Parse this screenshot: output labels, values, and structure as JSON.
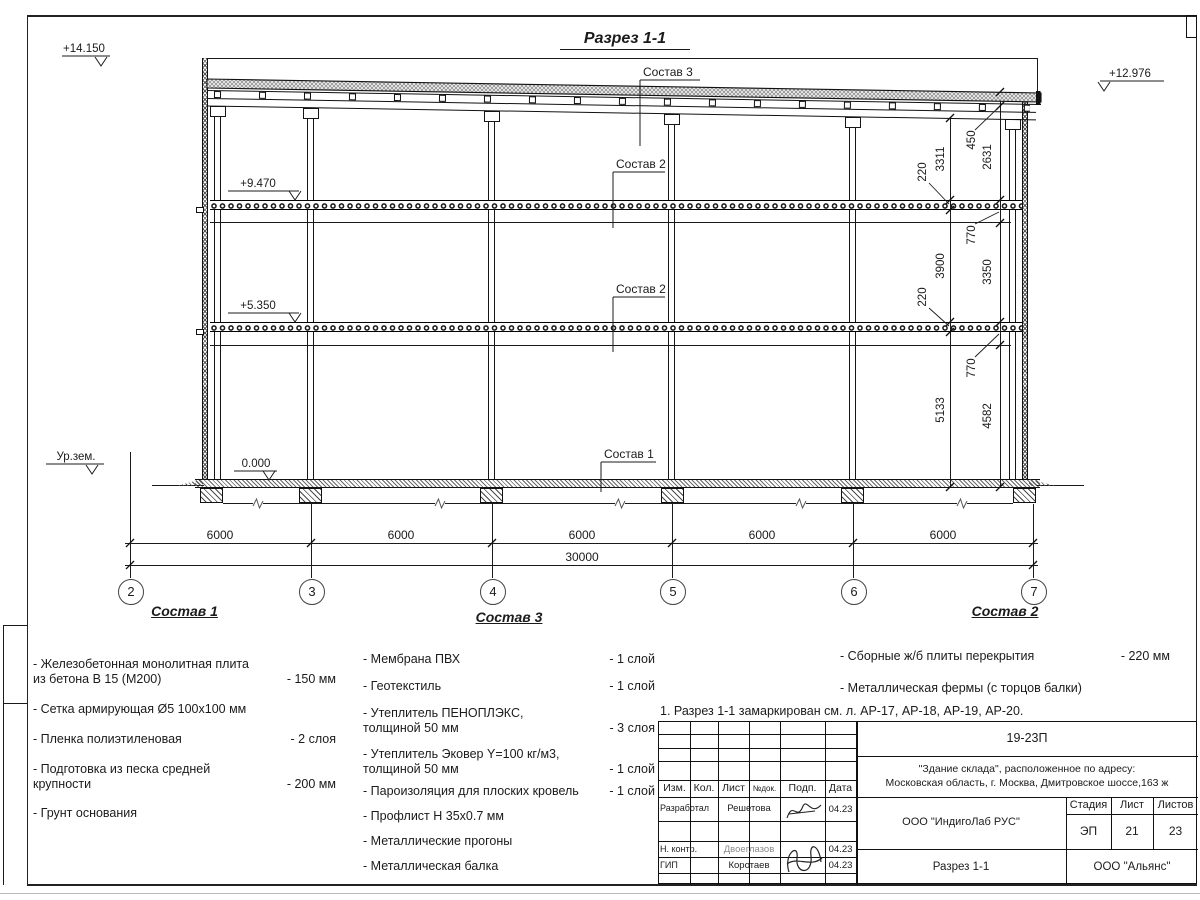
{
  "colors": {
    "line": "#1b1b1b",
    "hatch": "#8f8f8f"
  },
  "drawing": {
    "title": "Разрез 1-1",
    "elevation_marks": {
      "parapet": "+14.150",
      "roof_right": "+12.976",
      "slab_upper": "+9.470",
      "slab_lower": "+5.350",
      "floor": "0.000",
      "ground": "Ур.зем."
    },
    "composition_leaders": {
      "roof": "Состав 3",
      "slab_upper": "Состав 2",
      "slab_lower": "Состав 2",
      "floor": "Состав 1"
    },
    "vertical_dims_inner": [
      "3311",
      "220",
      "3900",
      "220",
      "5133"
    ],
    "vertical_dims_outer": [
      "450",
      "2631",
      "770",
      "3350",
      "770",
      "4582"
    ],
    "bay_dims": [
      "6000",
      "6000",
      "6000",
      "6000",
      "6000"
    ],
    "total_dim": "30000",
    "axes": [
      "2",
      "3",
      "4",
      "5",
      "6",
      "7"
    ]
  },
  "compositions": [
    {
      "title": "Состав 1",
      "items": [
        {
          "text": "- Железобетонная  монолитная плита\n  из бетона В 15 (М200)",
          "value": "- 150 мм"
        },
        {
          "text": "- Сетка армирующая Ø5 100x100 мм",
          "value": ""
        },
        {
          "text": "- Пленка полиэтиленовая",
          "value": "-  2 слоя"
        },
        {
          "text": "- Подготовка из песка средней\n  крупности",
          "value": "- 200 мм"
        },
        {
          "text": "- Грунт основания",
          "value": ""
        }
      ]
    },
    {
      "title": "Состав 3",
      "items": [
        {
          "text": "- Мембрана ПВХ",
          "value": "- 1 слой"
        },
        {
          "text": "- Геотекстиль",
          "value": "- 1 слой"
        },
        {
          "text": "- Утеплитель ПЕНОПЛЭКС,\n  толщиной 50 мм",
          "value": "- 3 слоя"
        },
        {
          "text": "- Утеплитель Эковер Y=100 кг/м3,\n  толщиной 50 мм",
          "value": "- 1 слой"
        },
        {
          "text": "- Пароизоляция для плоских кровель",
          "value": "- 1 слой"
        },
        {
          "text": "- Профлист Н 35х0.7 мм",
          "value": ""
        },
        {
          "text": "- Металлические прогоны",
          "value": ""
        },
        {
          "text": "- Металлическая балка",
          "value": ""
        }
      ]
    },
    {
      "title": "Состав 2",
      "items": [
        {
          "text": "- Сборные ж/б плиты перекрытия",
          "value": "- 220 мм"
        },
        {
          "text": "- Металлическая фермы (с торцов балки)",
          "value": ""
        }
      ]
    }
  ],
  "note": "1. Разрез 1-1 замаркирован см. л. АР-17, АР-18, АР-19, АР-20.",
  "title_block": {
    "doc_code": "19-23П",
    "project": "\"Здание склада\", расположенное по адресу:\nМосковская область, г. Москва, Дмитровское шоссе,163 ж",
    "cols": [
      "Изм.",
      "Кол.",
      "Лист",
      "№док.",
      "Подп.",
      "Дата"
    ],
    "rows": [
      {
        "role": "Разработал",
        "name": "Решетова",
        "date": "04.23"
      },
      {
        "role": "Н. контр.",
        "name": "Двоеглазов",
        "date": "04.23"
      },
      {
        "role": "ГИП",
        "name": "Коротаев",
        "date": "04.23"
      }
    ],
    "designer": "ООО \"ИндигоЛаб РУС\"",
    "stage_label": "Стадия",
    "sheet_label": "Лист",
    "sheets_label": "Листов",
    "stage": "ЭП",
    "sheet_no": "21",
    "sheets_total": "23",
    "drawing_name": "Разрез 1-1",
    "client": "ООО \"Альянс\""
  }
}
